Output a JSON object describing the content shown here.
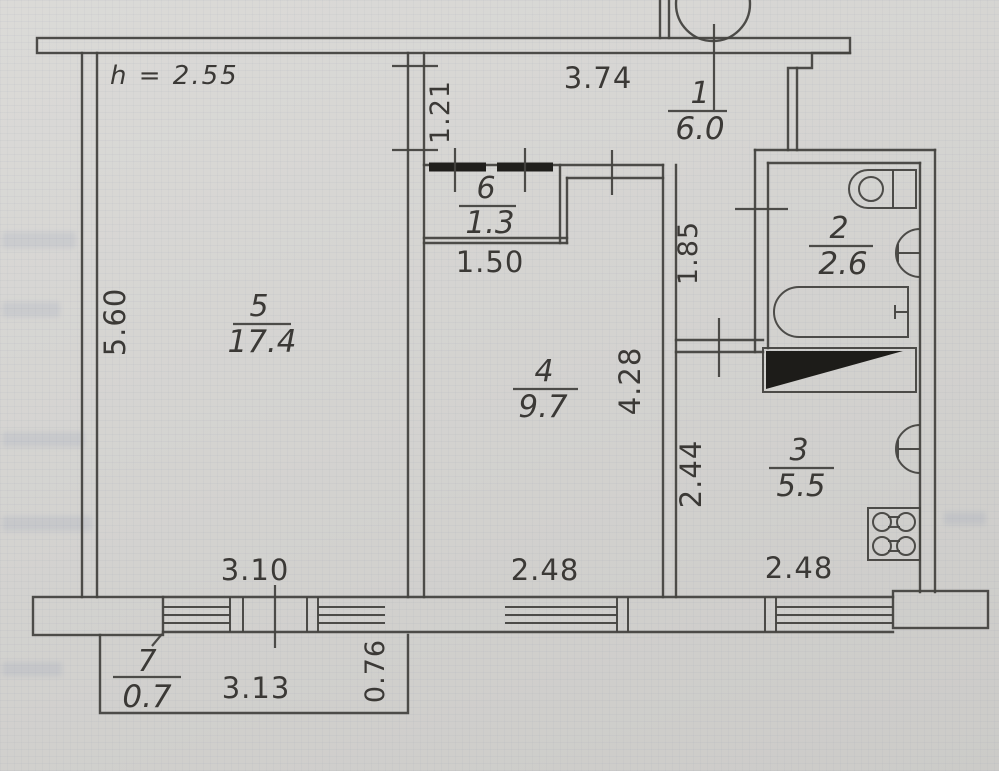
{
  "plan": {
    "ceiling_height_note": "h = 2.55",
    "rooms": [
      {
        "number": "1",
        "area": "6.0"
      },
      {
        "number": "2",
        "area": "2.6"
      },
      {
        "number": "3",
        "area": "5.5"
      },
      {
        "number": "4",
        "area": "9.7"
      },
      {
        "number": "5",
        "area": "17.4"
      },
      {
        "number": "6",
        "area": "1.3"
      },
      {
        "number": "7",
        "area": "0.7"
      }
    ],
    "dimensions": {
      "room5_height": "5.60",
      "hall_width": "3.74",
      "hall_niche": "1.21",
      "closet_width": "1.50",
      "corridor_upper": "1.85",
      "room4_depth": "4.28",
      "corridor_lower": "2.44",
      "room5_window": "3.10",
      "room4_window": "2.48",
      "kitchen_window": "2.48",
      "balcony_length": "3.13",
      "balcony_depth": "0.76"
    },
    "colors": {
      "paper": "#d7d6d3",
      "line": "#454340",
      "ink": "#3b3936",
      "solid_fill": "#1d1c19"
    }
  }
}
